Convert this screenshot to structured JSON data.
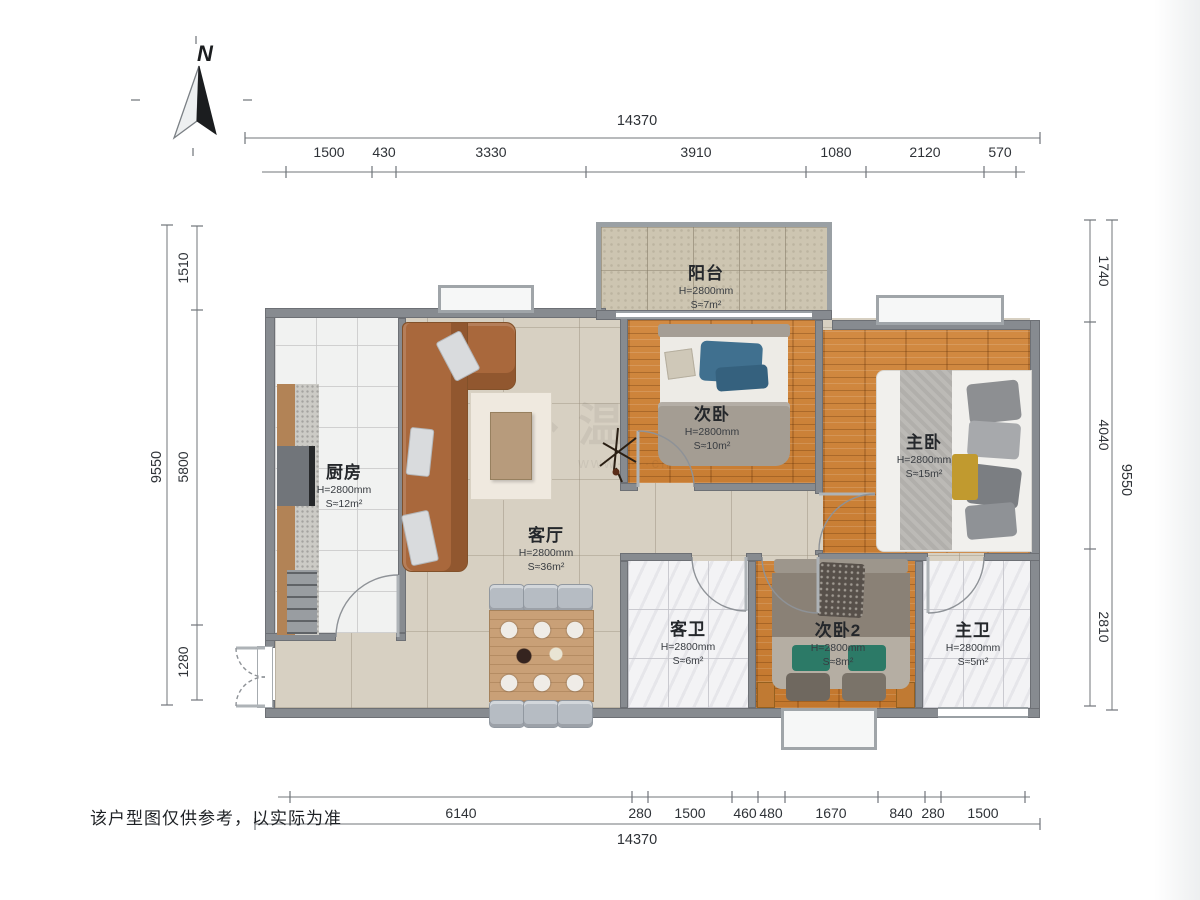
{
  "compass": {
    "label": "N"
  },
  "disclaimer": "该户型图仅供参考，以实际为准",
  "watermark": {
    "char": "温",
    "url": "www·····cn"
  },
  "dims": {
    "top": {
      "total": "14370",
      "segs": [
        "1500",
        "430",
        "3330",
        "3910",
        "1080",
        "2120",
        "570"
      ]
    },
    "bottom": {
      "total": "14370",
      "segs": [
        "6140",
        "280",
        "1500",
        "460",
        "480",
        "1670",
        "840",
        "280",
        "1500"
      ]
    },
    "left": {
      "total": "9550",
      "segs": [
        "1510",
        "5800",
        "1280"
      ]
    },
    "right": {
      "total": "9550",
      "segs": [
        "1740",
        "4040",
        "2810"
      ]
    }
  },
  "rooms": [
    {
      "id": "balcony",
      "name": "阳台",
      "h": "H=2800mm",
      "s": "S≈7m²"
    },
    {
      "id": "bedroom2",
      "name": "次卧",
      "h": "H=2800mm",
      "s": "S≈10m²"
    },
    {
      "id": "master",
      "name": "主卧",
      "h": "H=2800mm",
      "s": "S≈15m²"
    },
    {
      "id": "kitchen",
      "name": "厨房",
      "h": "H=2800mm",
      "s": "S≈12m²"
    },
    {
      "id": "living",
      "name": "客厅",
      "h": "H=2800mm",
      "s": "S≈36m²"
    },
    {
      "id": "guestbath",
      "name": "客卫",
      "h": "H=2800mm",
      "s": "S≈6m²"
    },
    {
      "id": "bedroom3",
      "name": "次卧2",
      "h": "H=2800mm",
      "s": "S≈8m²"
    },
    {
      "id": "masterbath",
      "name": "主卫",
      "h": "H=2800mm",
      "s": "S≈5m²"
    }
  ]
}
